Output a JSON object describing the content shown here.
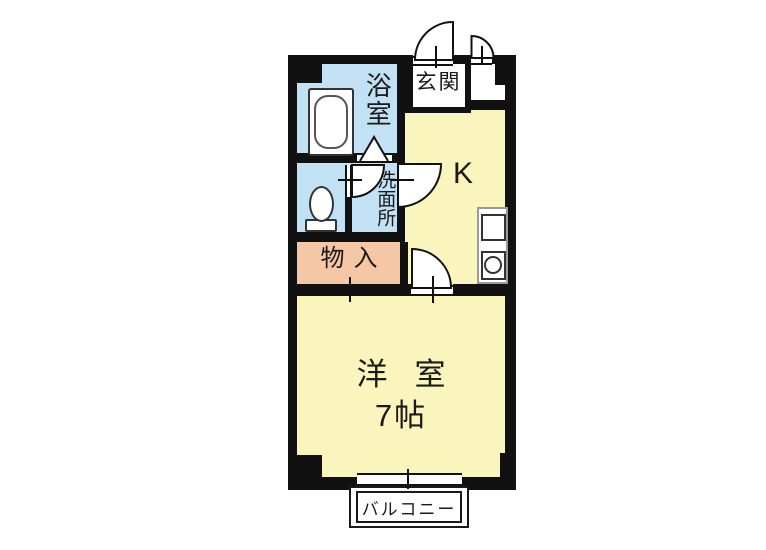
{
  "floor_plan": {
    "rooms": {
      "bathroom": {
        "label": "浴室"
      },
      "entrance": {
        "label": "玄関"
      },
      "kitchen": {
        "label": "K"
      },
      "washroom": {
        "label": "洗面所"
      },
      "storage": {
        "label": "物入"
      },
      "western_room": {
        "label": "洋室",
        "size": "7帖"
      },
      "balcony": {
        "label": "バルコニー"
      }
    },
    "colors": {
      "wall": "#111111",
      "wet_area_fill": "#c3e1f4",
      "room_fill": "#faf4bd",
      "storage_fill": "#f6c7a5"
    },
    "icons": {
      "bathtub": "bathtub-icon",
      "toilet": "toilet-icon",
      "stove": "stove-icon",
      "sink": "sink-circle-icon",
      "doors": "door-swing-icon",
      "bathroom_door": "folding-door-icon",
      "window": "sliding-window-icon"
    }
  }
}
